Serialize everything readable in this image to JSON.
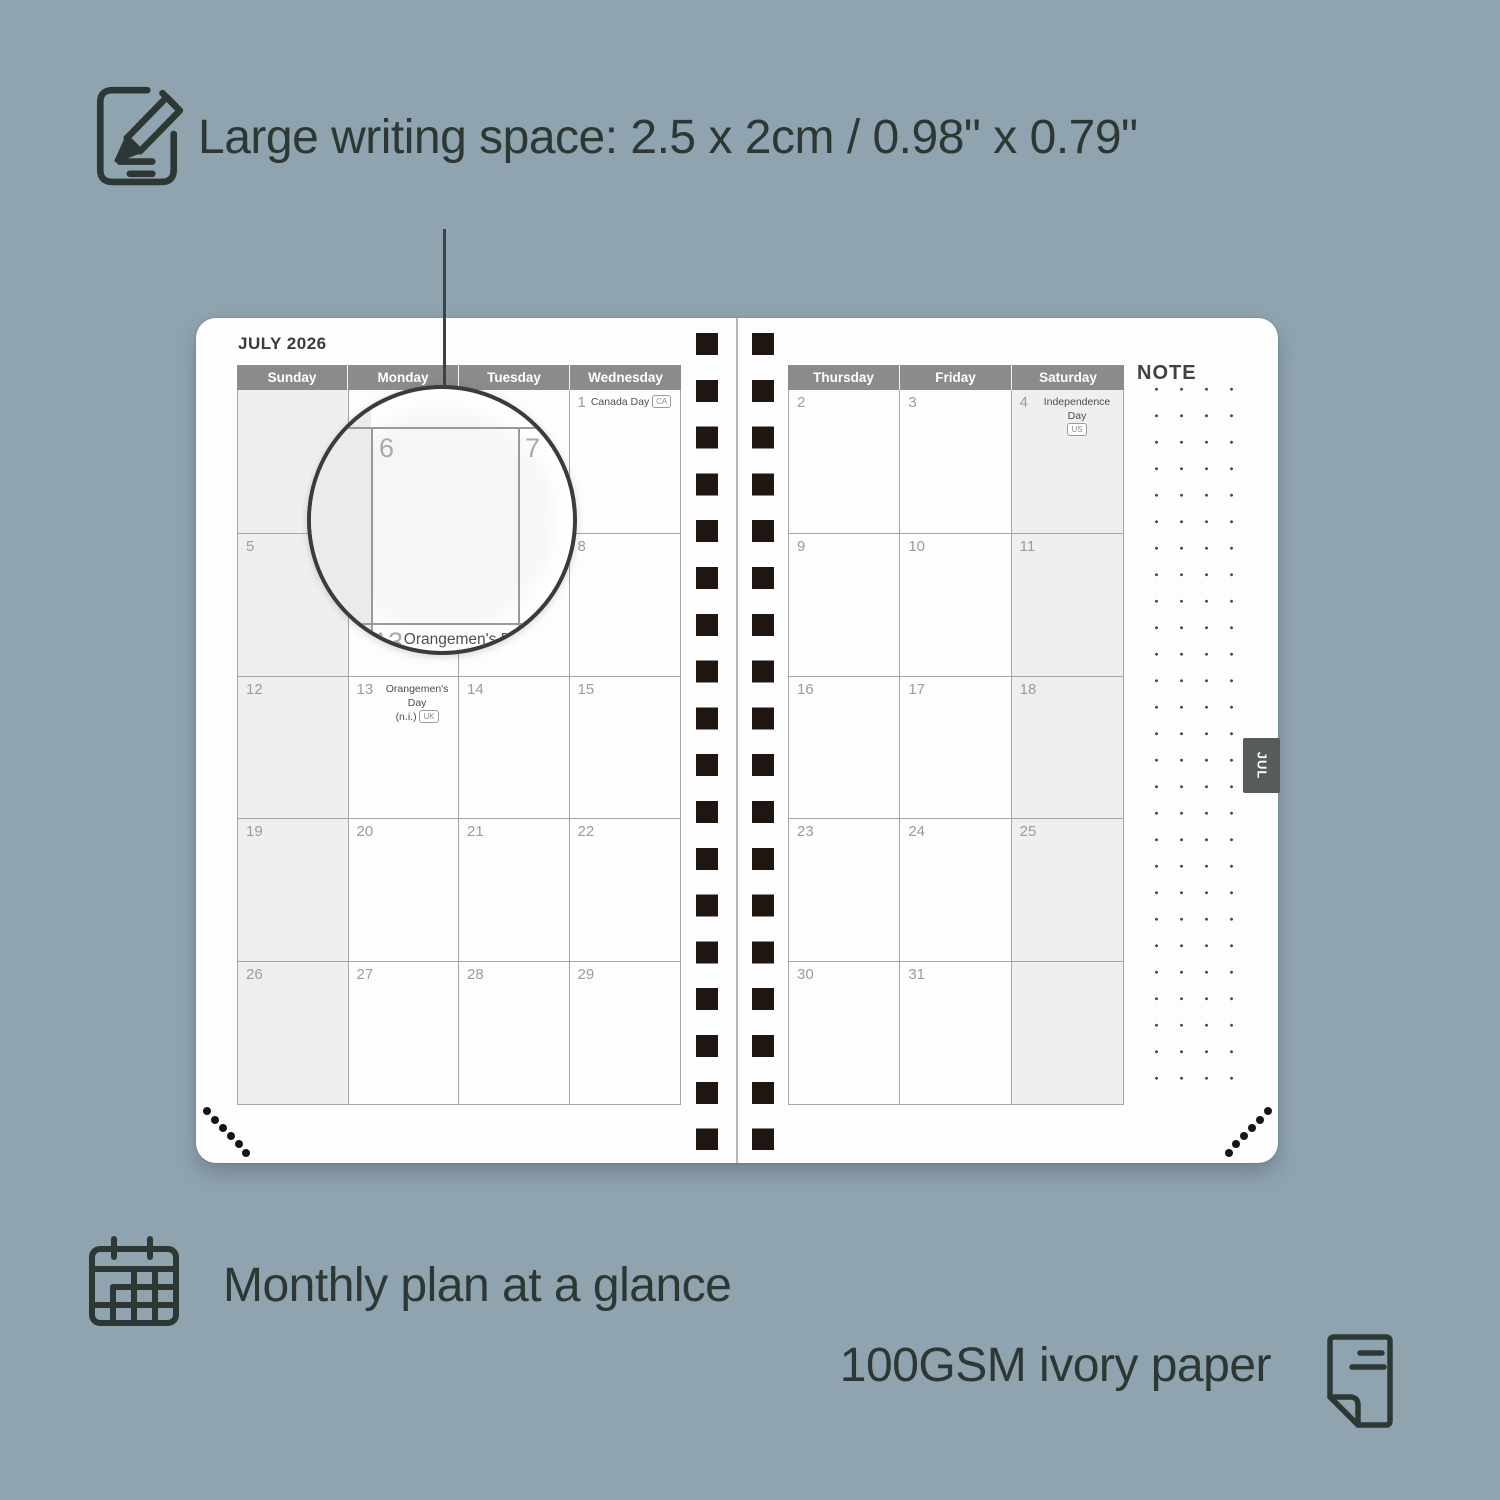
{
  "features": {
    "writing_space": "Large writing space: 2.5 x 2cm / 0.98\" x 0.79\"",
    "monthly_plan": "Monthly plan at a glance",
    "paper": "100GSM ivory paper"
  },
  "planner": {
    "title": "JULY 2026",
    "note_label": "NOTE",
    "tab_label": "JUL",
    "left_page": {
      "day_headers": [
        "Sunday",
        "Monday",
        "Tuesday",
        "Wednesday"
      ],
      "shaded_column": 0,
      "rows": [
        [
          {
            "day": ""
          },
          {
            "day": ""
          },
          {
            "day": ""
          },
          {
            "day": "1",
            "holiday": {
              "line1": "Canada Day",
              "badge": "CA",
              "badge_line": 1
            }
          }
        ],
        [
          {
            "day": "5"
          },
          {
            "day": "6"
          },
          {
            "day": "7"
          },
          {
            "day": "8"
          }
        ],
        [
          {
            "day": "12"
          },
          {
            "day": "13",
            "holiday": {
              "line1": "Orangemen's Day",
              "line2": "(n.i.)",
              "badge": "UK",
              "badge_line": 2
            }
          },
          {
            "day": "14"
          },
          {
            "day": "15"
          }
        ],
        [
          {
            "day": "19"
          },
          {
            "day": "20"
          },
          {
            "day": "21"
          },
          {
            "day": "22"
          }
        ],
        [
          {
            "day": "26"
          },
          {
            "day": "27"
          },
          {
            "day": "28"
          },
          {
            "day": "29"
          }
        ]
      ]
    },
    "right_page": {
      "day_headers": [
        "Thursday",
        "Friday",
        "Saturday"
      ],
      "shaded_column": 2,
      "rows": [
        [
          {
            "day": "2"
          },
          {
            "day": "3"
          },
          {
            "day": "4",
            "holiday": {
              "line1": "Independence Day",
              "line2": "",
              "badge": "US",
              "badge_line": 2
            }
          }
        ],
        [
          {
            "day": "9"
          },
          {
            "day": "10"
          },
          {
            "day": "11"
          }
        ],
        [
          {
            "day": "16"
          },
          {
            "day": "17"
          },
          {
            "day": "18"
          }
        ],
        [
          {
            "day": "23"
          },
          {
            "day": "24"
          },
          {
            "day": "25"
          }
        ],
        [
          {
            "day": "30"
          },
          {
            "day": "31"
          },
          {
            "day": ""
          }
        ]
      ]
    },
    "magnifier": {
      "day_left": "6",
      "day_right": "7",
      "bottom_day": "13",
      "bottom_holiday": "Orangemen's Day",
      "bottom_holiday_line2": "(n.i.)",
      "bottom_badge": "UK"
    }
  },
  "colors": {
    "background": "#90a4b0",
    "dark_text": "#2d3835",
    "header_gray": "#8b8b8b",
    "shaded_cell": "#efefee",
    "spiral": "#1f1511",
    "tab": "#575c5a"
  }
}
